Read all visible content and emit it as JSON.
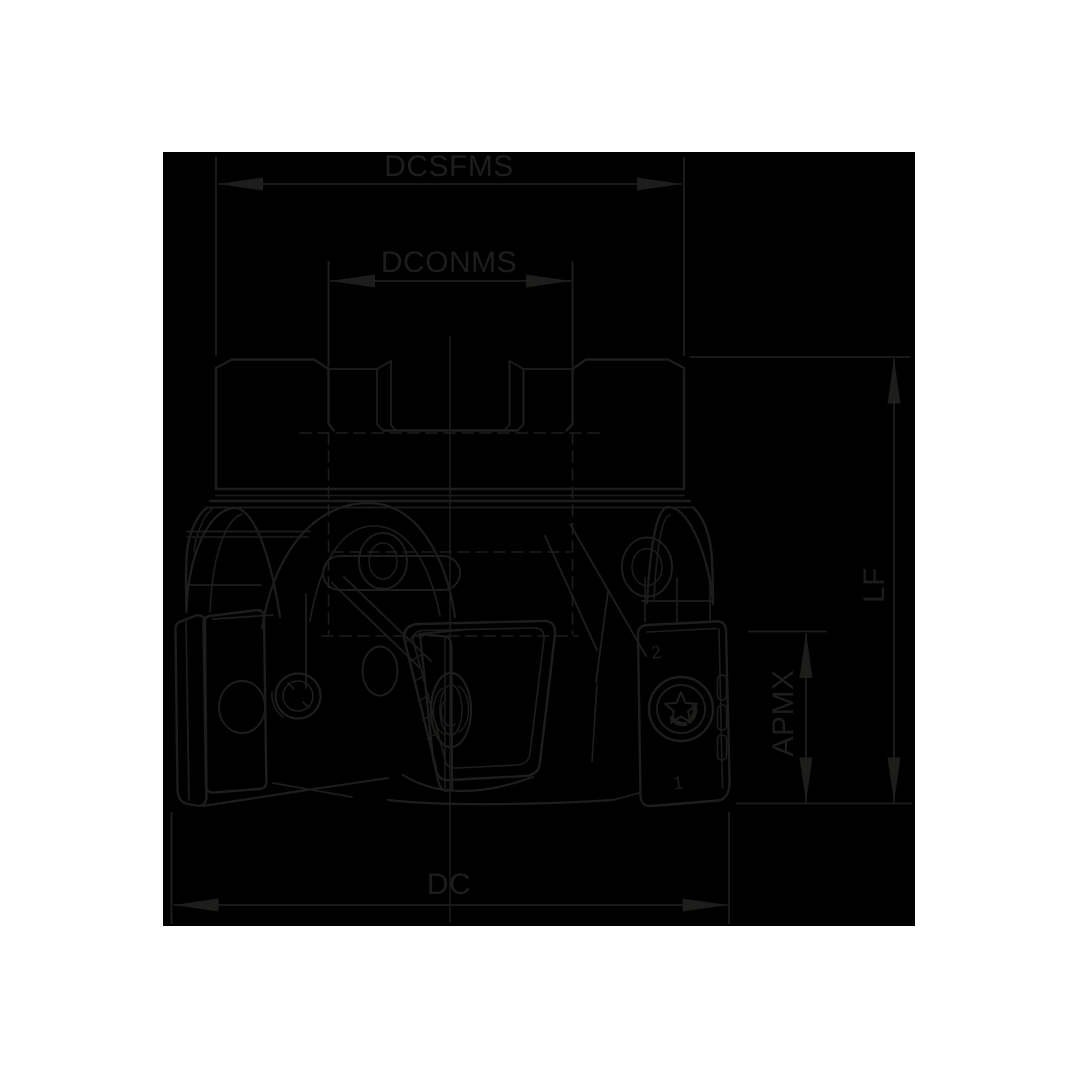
{
  "labels": {
    "dcsfms": "DCSFMS",
    "dconms": "DCONMS",
    "lf": "LF",
    "apmx": "APMX",
    "dc": "DC"
  },
  "marks": {
    "insert_index_top": "2",
    "insert_index_bottom": "1"
  },
  "colors": {
    "background": "#ffffff",
    "panel": "#000000",
    "line": "#1d1d1b"
  }
}
